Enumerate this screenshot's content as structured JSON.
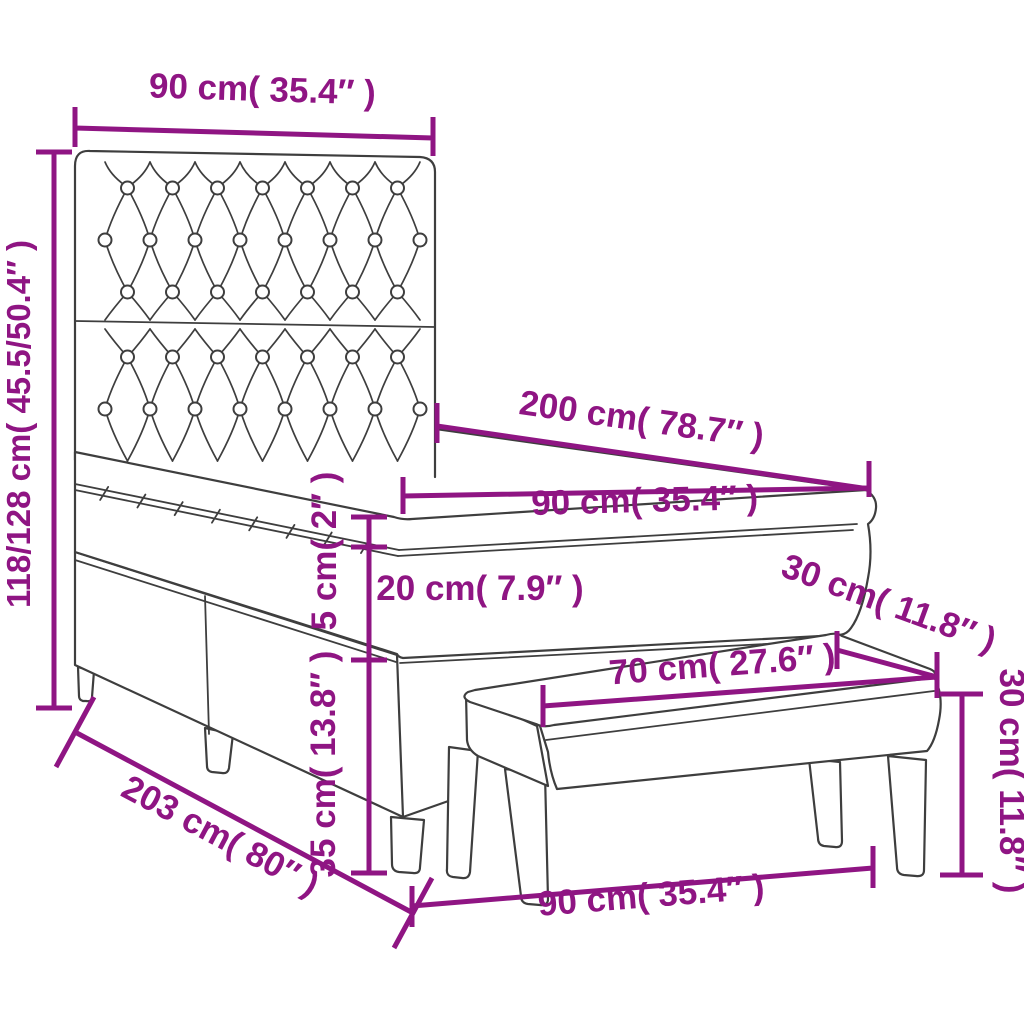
{
  "colors": {
    "dimension_text": "#8F1583",
    "line_art": "#3E3E3E",
    "background": "#FFFFFF"
  },
  "bed": {
    "headboard_width": "90 cm( 35.4″ )",
    "height": "118/128 cm( 45.5/50.4″ )",
    "length": "200 cm( 78.7″ )",
    "width": "90 cm( 35.4″ )",
    "topper_thickness": "5 cm( 2″ )",
    "mattress_thickness": "20 cm( 7.9″ )",
    "base_height": "35 cm( 13.8″ )",
    "total_length": "203 cm( 80″ )"
  },
  "bench": {
    "width": "90 cm( 35.4″ )",
    "seat_length": "70 cm( 27.6″ )",
    "depth": "30 cm( 11.8″ )",
    "height": "30 cm( 11.8″ )"
  }
}
